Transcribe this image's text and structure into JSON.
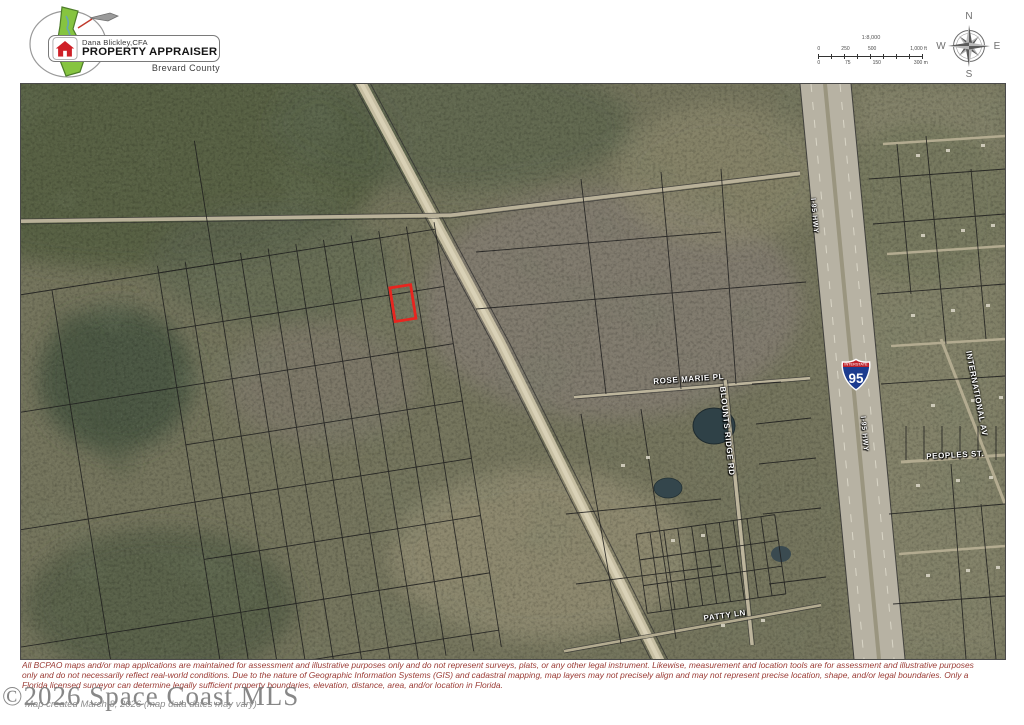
{
  "colors": {
    "highlight_red": "#e8251f",
    "disclaimer_text": "#9a3b34",
    "interstate_blue": "#1d3c8f",
    "interstate_red": "#c0232c",
    "logo_green": "#86c440",
    "house_red": "#cf2027"
  },
  "header": {
    "logo": {
      "owner": "Dana Blickley,CFA",
      "title": "PROPERTY APPRAISER",
      "county": "Brevard County"
    },
    "scale_bar": {
      "ratio": "1:8,000",
      "feet": [
        "0",
        "250",
        "500",
        "1,000 ft"
      ],
      "meters": [
        "0",
        "75",
        "150",
        "300 m"
      ]
    },
    "compass": {
      "north": "N",
      "east": "E",
      "south": "S",
      "west": "W"
    }
  },
  "map": {
    "shield": {
      "banner": "INTERSTATE",
      "route": "95"
    },
    "labels": {
      "rose_marie": "ROSE MARIE PL",
      "blounts_ridge": "BLOUNTS RIDGE RD",
      "international": "INTERNATIONAL AV",
      "peoples": "PEOPLES ST.",
      "patty": "PATTY LN",
      "i95_upper": "I-95 HWY",
      "i95_lower": "I-95 HWY"
    }
  },
  "footer": {
    "disclaimer_lines": [
      "All BCPAO maps and/or map applications are maintained for assessment and illustrative purposes only and do not represent surveys, plats, or any other legal instrument. Likewise, measurement and location tools are for assessment and illustrative purposes",
      "only and do not necessarily reflect real-world conditions. Due to the nature of Geographic Information Systems (GIS) and cadastral mapping, map layers may not precisely align and may not represent precise location, shape, and/or legal boundaries. Only a",
      "Florida licensed surveyor can determine legally sufficient property boundaries, elevation, distance, area, and/or location in Florida."
    ],
    "watermark": "©2026 Space Coast MLS",
    "created": "Map created March 8, 2026 (map data dates may vary)"
  }
}
